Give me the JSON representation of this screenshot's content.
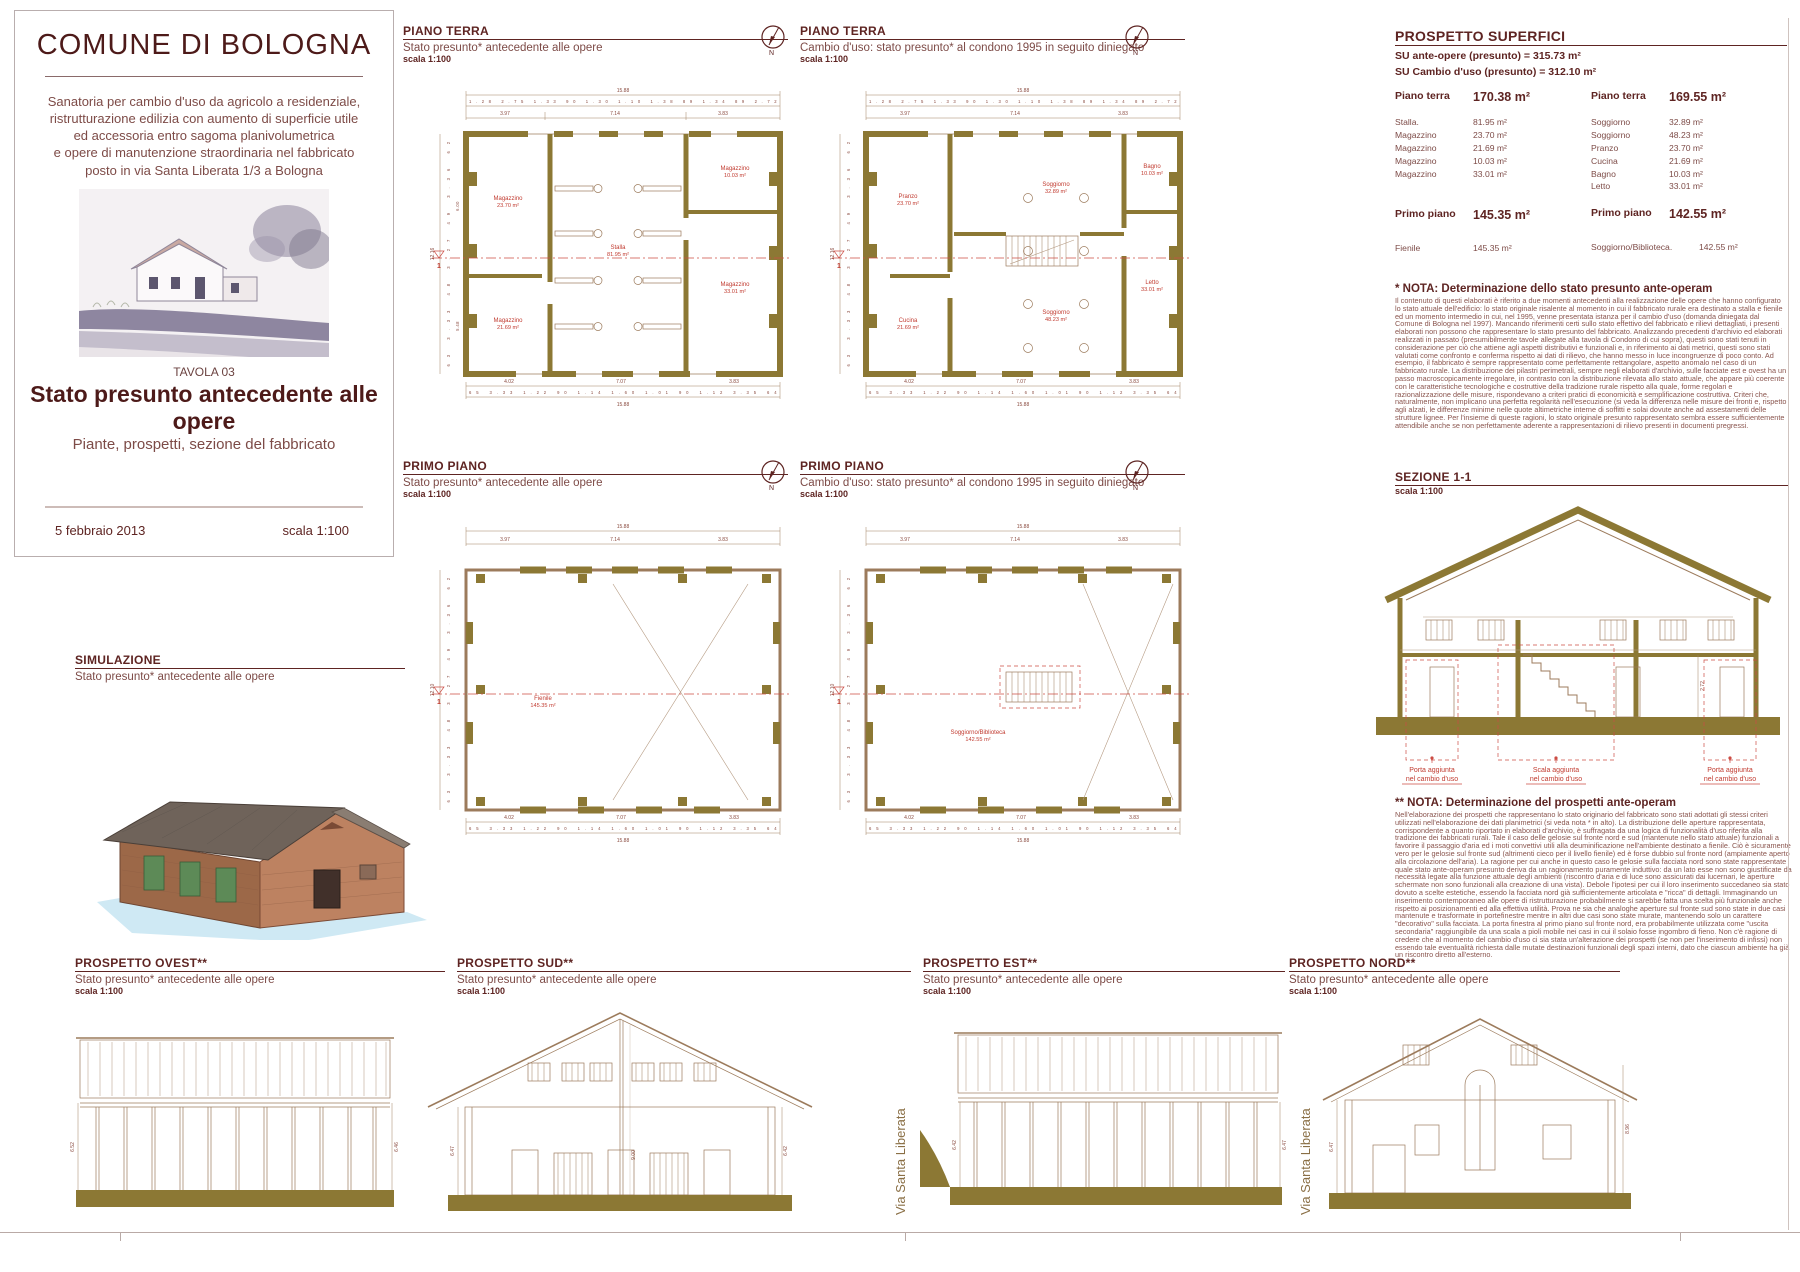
{
  "title_block": {
    "title": "COMUNE DI BOLOGNA",
    "d1": "Sanatoria per cambio d'uso da agricolo a residenziale,",
    "d2": "ristrutturazione edilizia con aumento di superficie utile",
    "d3": "ed accessoria entro sagoma planivolumetrica",
    "d4": "e opere di manutenzione straordinaria nel fabbricato",
    "d5": "posto in via Santa Liberata 1/3 a Bologna",
    "tavola": "TAVOLA 03",
    "main_title": "Stato presunto antecedente alle opere",
    "subtitle": "Piante, prospetti, sezione del fabbricato",
    "date": "5 febbraio 2013",
    "scale": "scala 1:100"
  },
  "north_n": "N",
  "street": "Via Santa Liberata",
  "simulazione": {
    "title": "SIMULAZIONE",
    "subtitle": "Stato presunto* antecedente alle opere"
  },
  "dims_shared": {
    "micro_top": "1.28   2.75   1.33   90   1.30   1.10   1.38   89   1.34   89   2.72",
    "micro_bottom": "65   3.33   1.22   90   1.14   1.60   1.01   90   1.12   3.35   64",
    "left_chain": "63   3.33   48   3.27   49   3.36   62",
    "t1": "3.97",
    "t2": "7.14",
    "t3": "3.83",
    "b1": "4.02",
    "b2": "7.07",
    "b3": "3.83",
    "total": "15.88",
    "l_sec1": "6.00",
    "l_sec2": "5.48"
  },
  "plans": {
    "pt_a": {
      "title": "PIANO TERRA",
      "subtitle": "Stato presunto* antecedente alle opere",
      "scale": "scala 1:100",
      "left_total": "12.16",
      "cut": "1",
      "rooms": [
        {
          "n": "Magazzino",
          "a": "23.70 m²"
        },
        {
          "n": "Magazzino",
          "a": "21.69 m²"
        },
        {
          "n": "Stalla",
          "a": "81.95 m²"
        },
        {
          "n": "Magazzino",
          "a": "10.03 m²"
        },
        {
          "n": "Magazzino",
          "a": "33.01 m²"
        }
      ]
    },
    "pt_b": {
      "title": "PIANO TERRA",
      "subtitle": "Cambio d'uso: stato presunto* al condono 1995 in seguito diniegato",
      "scale": "scala 1:100",
      "left_total": "12.16",
      "cut": "1",
      "rooms": [
        {
          "n": "Pranzo",
          "a": "23.70 m²"
        },
        {
          "n": "Cucina",
          "a": "21.69 m²"
        },
        {
          "n": "Soggiorno",
          "a": "32.89 m²"
        },
        {
          "n": "Soggiorno",
          "a": "48.23 m²"
        },
        {
          "n": "Bagno",
          "a": "10.03 m²"
        },
        {
          "n": "Letto",
          "a": "33.01 m²"
        }
      ]
    },
    "pp_a": {
      "title": "PRIMO PIANO",
      "subtitle": "Stato presunto* antecedente alle opere",
      "scale": "scala 1:100",
      "left_total": "12.10",
      "cut": "1",
      "rooms": [
        {
          "n": "Fienile",
          "a": "145.35 m²"
        }
      ]
    },
    "pp_b": {
      "title": "PRIMO PIANO",
      "subtitle": "Cambio d'uso: stato presunto* al condono 1995 in seguito diniegato",
      "scale": "scala 1:100",
      "left_total": "12.10",
      "cut": "1",
      "rooms": [
        {
          "n": "Soggiorno/Biblioteca",
          "a": "142.55 m²"
        }
      ]
    }
  },
  "superfici": {
    "title": "PROSPETTO SUPERFICI",
    "su1": "SU ante-opere (presunto) = 315.73 m²",
    "su2": "SU Cambio d'uso (presunto) = 312.10 m²",
    "left": {
      "floor": "Piano terra",
      "floor_area": "170.38 m²",
      "rows": [
        [
          "Stalla.",
          "81.95 m²"
        ],
        [
          "Magazzino",
          "23.70 m²"
        ],
        [
          "Magazzino",
          "21.69 m²"
        ],
        [
          "Magazzino",
          "10.03 m²"
        ],
        [
          "Magazzino",
          "33.01 m²"
        ]
      ],
      "floor2": "Primo piano",
      "floor2_area": "145.35 m²",
      "row2": [
        "Fienile",
        "145.35 m²"
      ]
    },
    "right": {
      "floor": "Piano terra",
      "floor_area": "169.55 m²",
      "rows": [
        [
          "Soggiorno",
          "32.89 m²"
        ],
        [
          "Soggiorno",
          "48.23 m²"
        ],
        [
          "Pranzo",
          "23.70 m²"
        ],
        [
          "Cucina",
          "21.69 m²"
        ],
        [
          "Bagno",
          "10.03 m²"
        ],
        [
          "Letto",
          "33.01 m²"
        ]
      ],
      "floor2": "Primo piano",
      "floor2_area": "142.55 m²",
      "row2": [
        "Soggiorno/Biblioteca.",
        "142.55 m²"
      ]
    }
  },
  "nota1": {
    "title": "* NOTA: Determinazione dello stato presunto ante-operam",
    "body": "Il contenuto di questi elaborati è riferito a due momenti antecedenti alla realizzazione delle opere che hanno configurato lo stato attuale dell'edificio: lo stato originale risalente al momento in cui il fabbricato rurale era destinato a stalla e fienile ed un momento intermedio in cui, nel 1995, venne presentata istanza per il cambio d'uso (domanda diniegata dal Comune di Bologna nel 1997). Mancando riferimenti certi sullo stato effettivo del fabbricato e rilievi dettagliati, i presenti elaborati non possono che rappresentare lo stato presunto del fabbricato. Analizzando precedenti d'archivio ed elaborati realizzati in passato (presumibilmente tavole allegate alla tavola di Condono di cui sopra), questi sono stati tenuti in considerazione per ciò che attiene agli aspetti distributivi e funzionali e, in riferimento ai dati metrici, questi sono stati valutati come confronto e conferma rispetto ai dati di rilievo, che hanno messo in luce incongruenze di poco conto. Ad esempio, il fabbricato è sempre rappresentato come perfettamente rettangolare, aspetto anomalo nel caso di un fabbricato rurale. La distribuzione dei pilastri perimetrali, sempre negli elaborati d'archivio, sulle facciate est e ovest ha un passo macroscopicamente irregolare, in contrasto con la distribuzione rilevata allo stato attuale, che appare più coerente con le caratteristiche tecnologiche e costruttive della tradizione rurale rispetto alla quale, forme regolari e razionalizzazione delle misure, rispondevano a criteri pratici di economicità e semplificazione costruttiva. Criteri che, naturalmente, non implicano una perfetta regolarità nell'esecuzione (si veda la differenza nelle misure dei fronti e, rispetto agli alzati, le differenze minime nelle quote altimetriche interne  di soffitti e solai dovute anche ad assestamenti delle strutture lignee. Per l'insieme di queste ragioni, lo stato originale presunto rappresentato sembra essere sufficientemente attendibile anche se non perfettamente aderente a rappresentazioni di rilievo presenti in documenti pregressi."
  },
  "nota2": {
    "title": "** NOTA: Determinazione del prospetti ante-operam",
    "body": "Nell'elaborazione dei prospetti che rappresentano lo stato originario del fabbricato sono stati adottati gli stessi criteri utilizzati nell'elaborazione dei dati planimetrici (si veda nota * in alto). La distribuzione delle aperture rappresentata, corrispondente a quanto riportato in elaborati d'archivio, è suffragata da una logica di funzionalità d'uso riferita alla tradizione dei fabbricati rurali. Tale il caso delle gelosie sul fronte nord e sud (mantenute nello stato attuale) funzionali a favorire il passaggio d'aria ed i moti convettivi utili alla deuminificazione nell'ambiente destinato a fienile. Ciò è sicuramente vero per le gelosie sul fronte sud (altrimenti cieco per il livello fienile) ed è forse dubbio sul fronte nord (ampiamente aperto alla circolazione dell'aria). La ragione per cui anche in questo caso le gelosie sulla facciata nord sono state rappresentate quale stato ante-operam presunto deriva da un ragionamento puramente induttivo: da un lato esse non sono giustificate da necessità legate alla funzione attuale degli ambienti (riscontro d'aria e di luce sono assicurati dai lucernari, le aperture schermate non sono funzionali alla creazione di una vista). Debole l'ipotesi per cui il loro inserimento succedaneo sia stato dovuto a scelte estetiche, essendo la facciata nord già sufficientemente articolata e \"ricca\" di dettagli. Immaginando un inserimento contemporaneo alle opere di ristrutturazione probabilmente si sarebbe fatta una scelta più funzionale anche rispetto ai posizionamenti ed alla effettiva utilità. Prova ne sia che analoghe aperture sul fronte sud sono state in due casi mantenute e trasformate in portefinestre mentre in altri due casi sono state murate, mantenendo solo un carattere \"decorativo\" sulla facciata. La porta finestra al primo piano sul fronte nord, era probabilmente utilizzata come \"uscita secondaria\" raggiungibile da una scala a pioli mobile nei casi in cui il solaio fosse ingombro di fieno. Non c'è ragione di credere che al momento del cambio d'uso ci sia stata un'alterazione dei prospetti (se non per l'inserimento di infissi) non essendo tale eventualità richiesta dalle mutate destinazioni funzionali degli spazi interni, dato che ciascun ambiente ha già un riscontro diretto all'esterno."
  },
  "sezione": {
    "title": "SEZIONE 1-1",
    "scale": "scala 1:100",
    "dim": "2.72",
    "lab1a": "Porta aggiunta",
    "lab1b": "nel cambio d'uso",
    "lab2a": "Scala aggiunta",
    "lab2b": "nel cambio d'uso",
    "lab3a": "Porta aggiunta",
    "lab3b": "nel cambio d'uso"
  },
  "prospetti": {
    "ovest": {
      "title": "PROSPETTO OVEST**",
      "subtitle": "Stato presunto* antecedente alle opere",
      "scale": "scala 1:100",
      "dl": "6.52",
      "dr": "6.46"
    },
    "sud": {
      "title": "PROSPETTO SUD**",
      "subtitle": "Stato presunto* antecedente alle opere",
      "scale": "scala 1:100",
      "dl": "6.47",
      "dc": "9.00",
      "dr": "6.42"
    },
    "est": {
      "title": "PROSPETTO EST**",
      "subtitle": "Stato presunto* antecedente alle opere",
      "scale": "scala 1:100",
      "dl": "6.42",
      "dr": "6.47"
    },
    "nord": {
      "title": "PROSPETTO NORD**",
      "subtitle": "Stato presunto* antecedente alle opere",
      "scale": "scala 1:100",
      "dl": "6.47",
      "dr": "8.96"
    }
  }
}
